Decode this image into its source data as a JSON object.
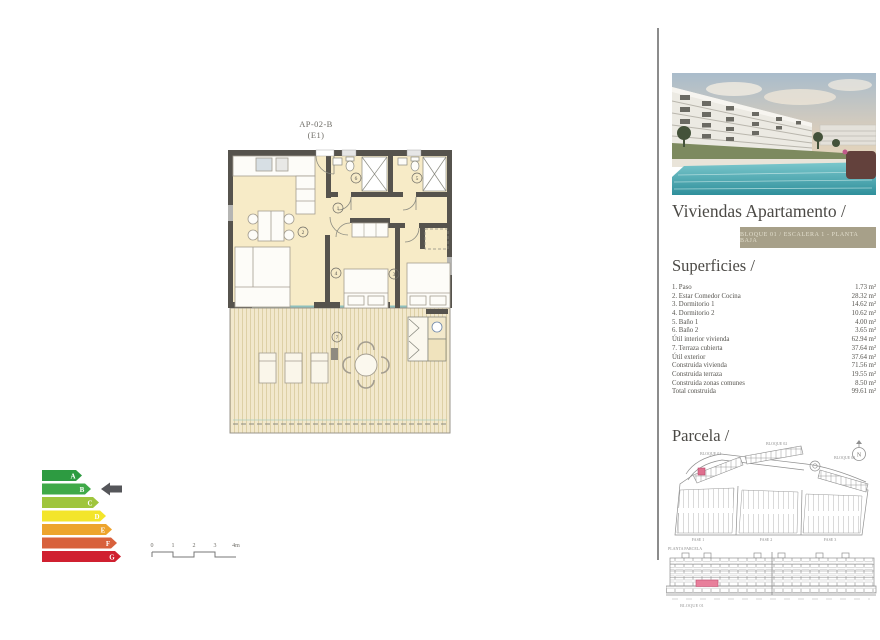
{
  "floor_plan": {
    "title_line1": "AP-02-B",
    "title_line2": "(E1)",
    "room_labels": [
      "1",
      "2",
      "3",
      "4",
      "5",
      "6",
      "7"
    ]
  },
  "energy_chart": {
    "type": "energy-rating-scale",
    "ratings": [
      {
        "letter": "A",
        "color": "#2d9b41"
      },
      {
        "letter": "B",
        "color": "#3fa948"
      },
      {
        "letter": "C",
        "color": "#9fc53d"
      },
      {
        "letter": "D",
        "color": "#f3e52b"
      },
      {
        "letter": "E",
        "color": "#eda42d"
      },
      {
        "letter": "F",
        "color": "#d8613c"
      },
      {
        "letter": "G",
        "color": "#d02030"
      }
    ],
    "selected": "B",
    "pointer_color": "#55565a"
  },
  "scale_bar": {
    "ticks": [
      "0",
      "1",
      "2",
      "3",
      "4m"
    ]
  },
  "right_panel": {
    "title": "Viviendas Apartamento /",
    "badge": "BLOQUE 01 / ESCALERA 1 - PLANTA BAJA",
    "badge_bg": "#a7a089",
    "superficies": {
      "heading": "Superficies /",
      "rows": [
        {
          "label": "1. Paso",
          "value": "1.73 m²"
        },
        {
          "label": "2. Estar Comedor Cocina",
          "value": "28.32 m²"
        },
        {
          "label": "3. Dormitorio 1",
          "value": "14.62 m²"
        },
        {
          "label": "4. Dormitorio 2",
          "value": "10.62 m²"
        },
        {
          "label": "5. Baño 1",
          "value": "4.00 m²"
        },
        {
          "label": "6. Baño 2",
          "value": "3.65 m²"
        },
        {
          "label": "Útil interior vivienda",
          "value": "62.94 m²"
        },
        {
          "label": "7. Terraza cubierta",
          "value": "37.64 m²"
        },
        {
          "label": "Útil exterior",
          "value": "37.64 m²"
        },
        {
          "label": "Construida vivienda",
          "value": "71.56 m²"
        },
        {
          "label": "Construida terraza",
          "value": "19.55 m²"
        },
        {
          "label": "Construida zonas comunes",
          "value": "8.50 m²"
        },
        {
          "label": "Total construida",
          "value": "99.61 m²"
        }
      ]
    },
    "parcela": {
      "heading": "Parcela /",
      "labels": {
        "bloque1": "BLOQUE 01",
        "bloque2": "BLOQUE 02",
        "bloque3": "BLOQUE 03",
        "fase1": "FASE 1",
        "fase2": "FASE 2",
        "fase3": "FASE 3",
        "caption": "PLANTA PARCELA",
        "north": "N"
      },
      "highlight_color": "#df6f8e"
    },
    "elevation": {
      "caption": "BLOQUE 01",
      "highlight_color": "#e87f9b"
    }
  }
}
